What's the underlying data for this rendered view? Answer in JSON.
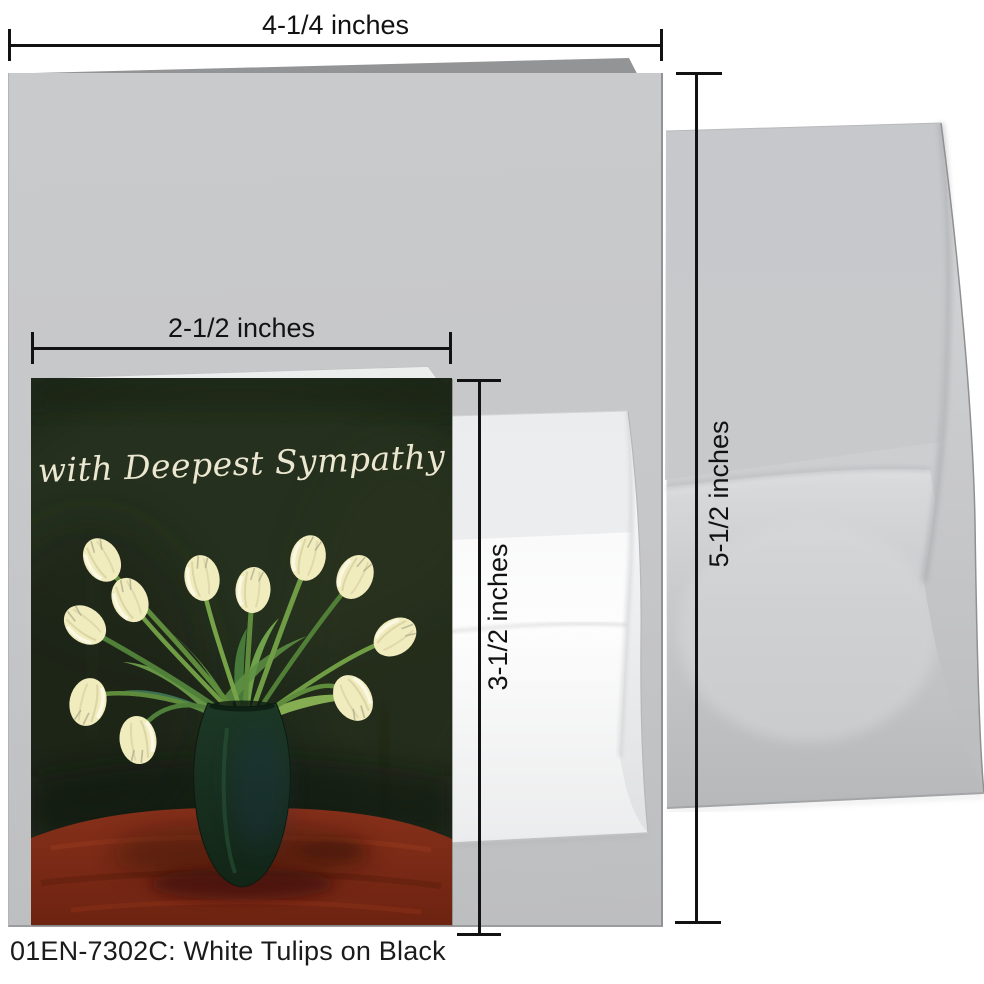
{
  "product": {
    "caption": "01EN-7302C: White Tulips on Black",
    "sku": "01EN-7302C",
    "design_title": "White Tulips on Black"
  },
  "card": {
    "greeting": "with Deepest Sympathy",
    "painting": {
      "subject": "eleven white tulips in a dark green vase on a red table",
      "tulip_count": 11
    }
  },
  "annotations": {
    "large_card_width": "4-1/4 inches",
    "large_card_height": "5-1/2 inches",
    "small_card_width": "2-1/2 inches",
    "small_card_height": "3-1/2 inches"
  },
  "colors": {
    "annotation_ink": "#121212",
    "large_card_gray": "#c6c7c9",
    "envelope_gray": "#cbccce",
    "envelope_white": "#fdfdfd",
    "art_background": "#202a1b",
    "tulip_cream": "#f1ecbe",
    "stem_green": "#5e8c3c",
    "vase_green": "#16301f",
    "table_red": "#7c2a15",
    "greeting_cream": "#ebe7d0"
  }
}
